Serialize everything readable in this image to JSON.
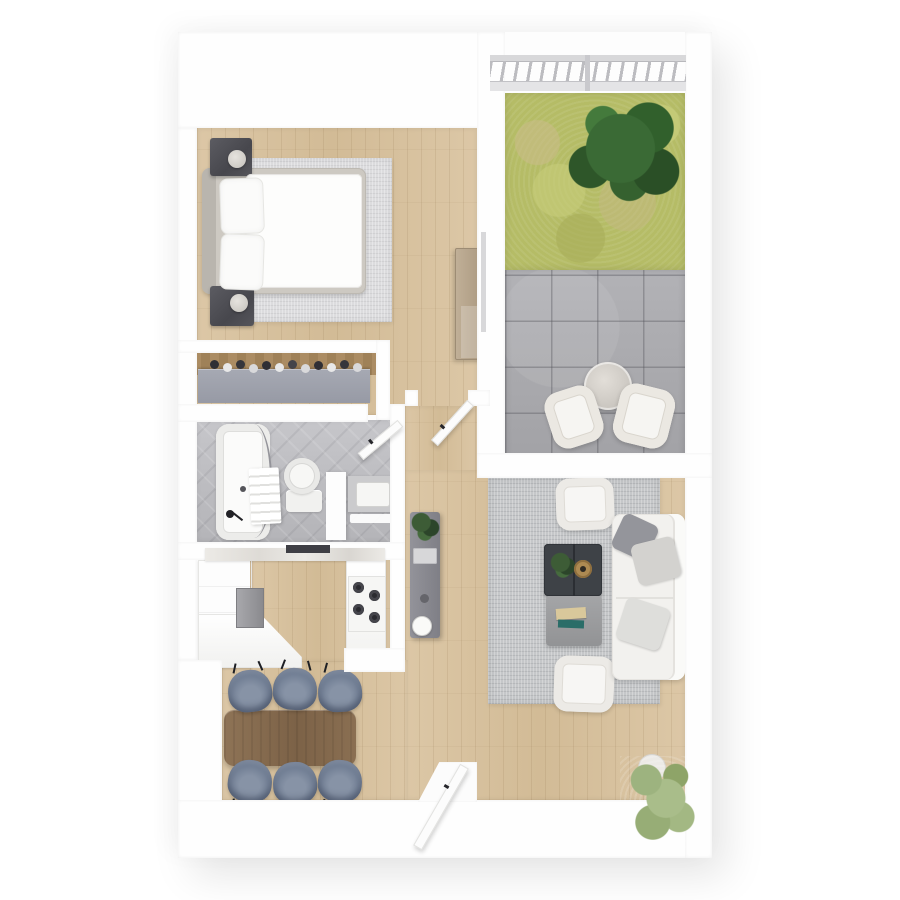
{
  "page": {
    "title": "3D apartment floor plan — top-down render",
    "type": "floor-plan",
    "canvas": {
      "width": 900,
      "height": 900
    }
  },
  "palette": {
    "wall": "#fefefe",
    "wood_floor": "#d8c3a1",
    "bath_tile": "#bfbfc3",
    "grass": "#b5bc66",
    "pavers": "#aaaaae",
    "living_rug": "#c5c7c9",
    "bedroom_rug": "#dcdcde",
    "dining_chair": "#66748b",
    "dining_table": "#8a6f52",
    "coffee_table": "#3e4247",
    "ottoman": "#9b9c9e",
    "nightstand": "#55555b",
    "console": "#8a8a90",
    "tree_green": "#3a6a35",
    "plant_green": "#a9bd8a"
  },
  "rooms": [
    {
      "name": "Bedroom",
      "floor": "light oak planks",
      "furniture": [
        "double bed with white duvet",
        "two stacked pillows",
        "grey headboard",
        "charcoal nightstand with lamp (top)",
        "charcoal nightstand with lamp (bottom)",
        "light grey area rug",
        "wood sideboard on partition wall"
      ]
    },
    {
      "name": "Wardrobe nook",
      "floor": "white",
      "furniture": [
        "built-in closet",
        "row of hanging clothes and shoes"
      ]
    },
    {
      "name": "Bathroom",
      "floor": "grey tile",
      "furniture": [
        "bathtub with curved curtain rod",
        "shower hand-set",
        "towel ladder",
        "toilet",
        "vanity with sink and faucet",
        "partition wall",
        "bath mat"
      ]
    },
    {
      "name": "Kitchen",
      "floor": "light oak planks",
      "furniture": [
        "white cabinet run",
        "marble worktop",
        "dark cooker hood strip",
        "steel oven",
        "4-burner hob",
        "L-shaped lower counter"
      ]
    },
    {
      "name": "Dining area",
      "floor": "light oak planks",
      "furniture": [
        "rectangular walnut table",
        "six slate-blue upholstered chairs"
      ]
    },
    {
      "name": "Living room",
      "floor": "light oak planks",
      "furniture": [
        "white three-seat sofa with grey cushions",
        "armchair north",
        "armchair south",
        "dark double coffee table with plant and brass tray",
        "grey ottoman with books",
        "large grey rug",
        "potted plant in corner"
      ]
    },
    {
      "name": "Balcony",
      "floor": "grass and concrete pavers",
      "furniture": [
        "metal railing",
        "green tree",
        "round bistro table",
        "two white lounge chairs"
      ]
    },
    {
      "name": "Hallway",
      "floor": "light oak planks",
      "furniture": [
        "grey console with plant, tray and kettle"
      ]
    }
  ],
  "doors": [
    {
      "name": "entry door",
      "state": "open",
      "location": "bottom wall"
    },
    {
      "name": "hall door",
      "state": "open",
      "location": "corridor between bedroom zone and hall"
    },
    {
      "name": "bathroom door",
      "state": "open",
      "location": "bathroom top-right corner"
    },
    {
      "name": "balcony sliding door",
      "state": "closed",
      "location": "balcony left wall"
    }
  ]
}
